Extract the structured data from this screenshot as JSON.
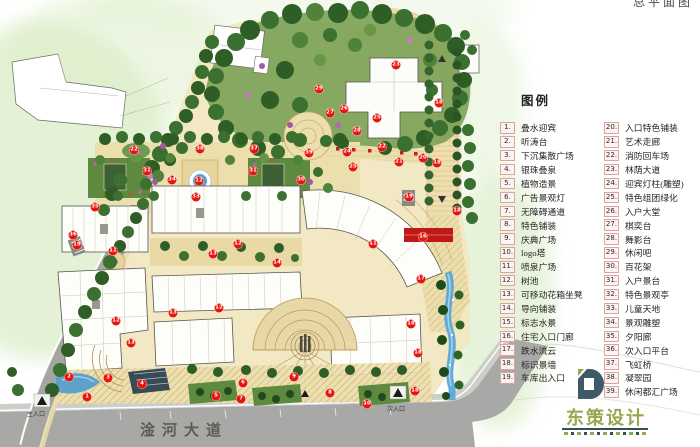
{
  "sheet": {
    "title_partial": "总平面图"
  },
  "map_labels": {
    "road_name": "淦河大道",
    "main_entrance": "主入口",
    "secondary_entrance": "次入口"
  },
  "legend": {
    "title": "图例",
    "col1": [
      {
        "num": "1.",
        "label": "叠水迎宾"
      },
      {
        "num": "2.",
        "label": "听涛台"
      },
      {
        "num": "3.",
        "label": "下沉集散广场"
      },
      {
        "num": "4.",
        "label": "银珠叠泉"
      },
      {
        "num": "5.",
        "label": "植物造景"
      },
      {
        "num": "6.",
        "label": "广告景观灯"
      },
      {
        "num": "7.",
        "label": "无障碍通道"
      },
      {
        "num": "8.",
        "label": "特色铺装"
      },
      {
        "num": "9.",
        "label": "庆典广场"
      },
      {
        "num": "10.",
        "label": "logo塔"
      },
      {
        "num": "11.",
        "label": "喷泉广场"
      },
      {
        "num": "12.",
        "label": "树池"
      },
      {
        "num": "13.",
        "label": "可移动花箱坐凳"
      },
      {
        "num": "14.",
        "label": "导向铺装"
      },
      {
        "num": "15.",
        "label": "标志水景"
      },
      {
        "num": "16.",
        "label": "住宅入口门廊"
      },
      {
        "num": "17.",
        "label": "跌水流云"
      },
      {
        "num": "18.",
        "label": "标识景墙"
      },
      {
        "num": "19.",
        "label": "车库出入口"
      }
    ],
    "col2": [
      {
        "num": "20.",
        "label": "入口特色铺装"
      },
      {
        "num": "21.",
        "label": "艺术走廊"
      },
      {
        "num": "22.",
        "label": "消防回车场"
      },
      {
        "num": "23.",
        "label": "林荫大道"
      },
      {
        "num": "24.",
        "label": "迎宾灯柱(雕塑)"
      },
      {
        "num": "25.",
        "label": "特色组团绿化"
      },
      {
        "num": "26.",
        "label": "入户大堂"
      },
      {
        "num": "27.",
        "label": "棋奕台"
      },
      {
        "num": "28.",
        "label": "舞影台"
      },
      {
        "num": "29.",
        "label": "休闲吧"
      },
      {
        "num": "30.",
        "label": "百花架"
      },
      {
        "num": "31.",
        "label": "入户景台"
      },
      {
        "num": "32.",
        "label": "特色景观亭"
      },
      {
        "num": "33.",
        "label": "儿童天地"
      },
      {
        "num": "34.",
        "label": "景观雕塑"
      },
      {
        "num": "35.",
        "label": "夕阳廊"
      },
      {
        "num": "36.",
        "label": "次入口平台"
      },
      {
        "num": "37.",
        "label": "飞虹桥"
      },
      {
        "num": "38.",
        "label": "凝翠园"
      },
      {
        "num": "39.",
        "label": "休闲都汇广场"
      }
    ]
  },
  "markers": [
    {
      "n": "1",
      "x": 87,
      "y": 397
    },
    {
      "n": "2",
      "x": 69,
      "y": 377
    },
    {
      "n": "3",
      "x": 108,
      "y": 378
    },
    {
      "n": "4",
      "x": 142,
      "y": 384
    },
    {
      "n": "5",
      "x": 216,
      "y": 396
    },
    {
      "n": "6",
      "x": 243,
      "y": 383
    },
    {
      "n": "7",
      "x": 241,
      "y": 399
    },
    {
      "n": "8",
      "x": 330,
      "y": 393
    },
    {
      "n": "9",
      "x": 294,
      "y": 377
    },
    {
      "n": "10",
      "x": 367,
      "y": 404
    },
    {
      "n": "11",
      "x": 113,
      "y": 251
    },
    {
      "n": "11",
      "x": 373,
      "y": 244
    },
    {
      "n": "12",
      "x": 199,
      "y": 181
    },
    {
      "n": "12",
      "x": 238,
      "y": 244
    },
    {
      "n": "12",
      "x": 116,
      "y": 321
    },
    {
      "n": "12",
      "x": 219,
      "y": 308
    },
    {
      "n": "13",
      "x": 213,
      "y": 254
    },
    {
      "n": "13",
      "x": 173,
      "y": 313
    },
    {
      "n": "13",
      "x": 131,
      "y": 343
    },
    {
      "n": "14",
      "x": 277,
      "y": 263
    },
    {
      "n": "16",
      "x": 423,
      "y": 237
    },
    {
      "n": "17",
      "x": 421,
      "y": 279
    },
    {
      "n": "18",
      "x": 439,
      "y": 103
    },
    {
      "n": "18",
      "x": 437,
      "y": 163
    },
    {
      "n": "18",
      "x": 457,
      "y": 211
    },
    {
      "n": "18",
      "x": 411,
      "y": 324
    },
    {
      "n": "18",
      "x": 418,
      "y": 353
    },
    {
      "n": "18",
      "x": 415,
      "y": 391
    },
    {
      "n": "19",
      "x": 77,
      "y": 245
    },
    {
      "n": "19",
      "x": 409,
      "y": 197
    },
    {
      "n": "20",
      "x": 423,
      "y": 158
    },
    {
      "n": "21",
      "x": 399,
      "y": 162
    },
    {
      "n": "22",
      "x": 134,
      "y": 150
    },
    {
      "n": "22",
      "x": 382,
      "y": 147
    },
    {
      "n": "23",
      "x": 396,
      "y": 65
    },
    {
      "n": "24",
      "x": 347,
      "y": 152
    },
    {
      "n": "25",
      "x": 377,
      "y": 118
    },
    {
      "n": "25",
      "x": 353,
      "y": 167
    },
    {
      "n": "26",
      "x": 344,
      "y": 109
    },
    {
      "n": "27",
      "x": 330,
      "y": 113
    },
    {
      "n": "28",
      "x": 357,
      "y": 131
    },
    {
      "n": "29",
      "x": 319,
      "y": 89
    },
    {
      "n": "30",
      "x": 301,
      "y": 180
    },
    {
      "n": "31",
      "x": 147,
      "y": 171
    },
    {
      "n": "31",
      "x": 253,
      "y": 171
    },
    {
      "n": "33",
      "x": 196,
      "y": 197
    },
    {
      "n": "34",
      "x": 172,
      "y": 180
    },
    {
      "n": "35",
      "x": 95,
      "y": 207
    },
    {
      "n": "36",
      "x": 73,
      "y": 235
    },
    {
      "n": "37",
      "x": 254,
      "y": 149
    },
    {
      "n": "38",
      "x": 200,
      "y": 149
    },
    {
      "n": "39",
      "x": 309,
      "y": 153
    }
  ],
  "logo": {
    "name": "东策设计"
  },
  "colors": {
    "marker_red": "#e8140c",
    "accent_red": "#cc1d15",
    "water_blue": "#5aa7d8",
    "tree_green": "#2f5d26",
    "paving_tan": "#ecdfae",
    "road_grey": "#a8a8a6",
    "logo_green": "#94a94e",
    "logo_slate": "#31505a"
  }
}
